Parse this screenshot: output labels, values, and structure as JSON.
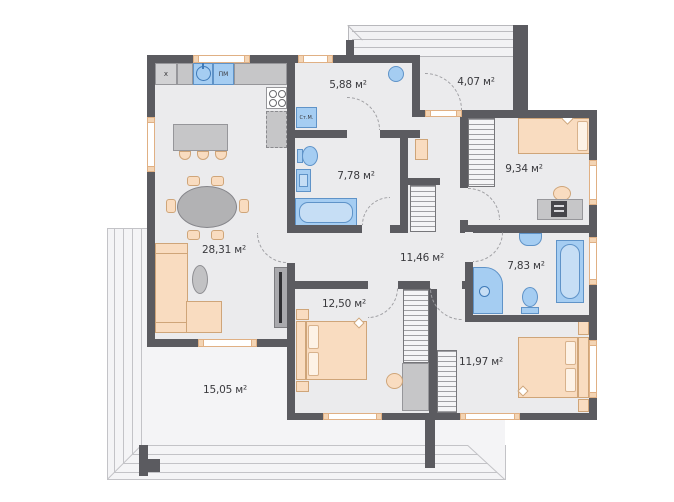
{
  "rooms": {
    "living": {
      "label": "28,31 м²"
    },
    "laundry": {
      "label": "5,88 м²"
    },
    "entry": {
      "label": "4,07 м²"
    },
    "bedroom1": {
      "label": "9,34 м²"
    },
    "bath1": {
      "label": "7,78 м²"
    },
    "hall": {
      "label": "11,46 м²"
    },
    "bath2": {
      "label": "7,83 м²"
    },
    "bedroom2": {
      "label": "12,50 м²"
    },
    "bedroom3": {
      "label": "11,97 м²"
    },
    "terrace": {
      "label": "15,05 м²"
    }
  },
  "appliances": {
    "fridge": "x",
    "dishwasher": "ПМ",
    "washer": "Ст.М."
  },
  "colors": {
    "wall": "#5b5b60",
    "room_floor": "#ebebed",
    "deck_floor": "#f4f4f6",
    "fixture_blue": "#a5cdf2",
    "fixture_blue_border": "#5f93c8",
    "furniture_peach": "#f9dcc0",
    "furniture_peach_border": "#cfa579",
    "furniture_gray": "#c6c6c8",
    "window_frame": "#e0b084",
    "door_arc": "#a0a0a4"
  }
}
